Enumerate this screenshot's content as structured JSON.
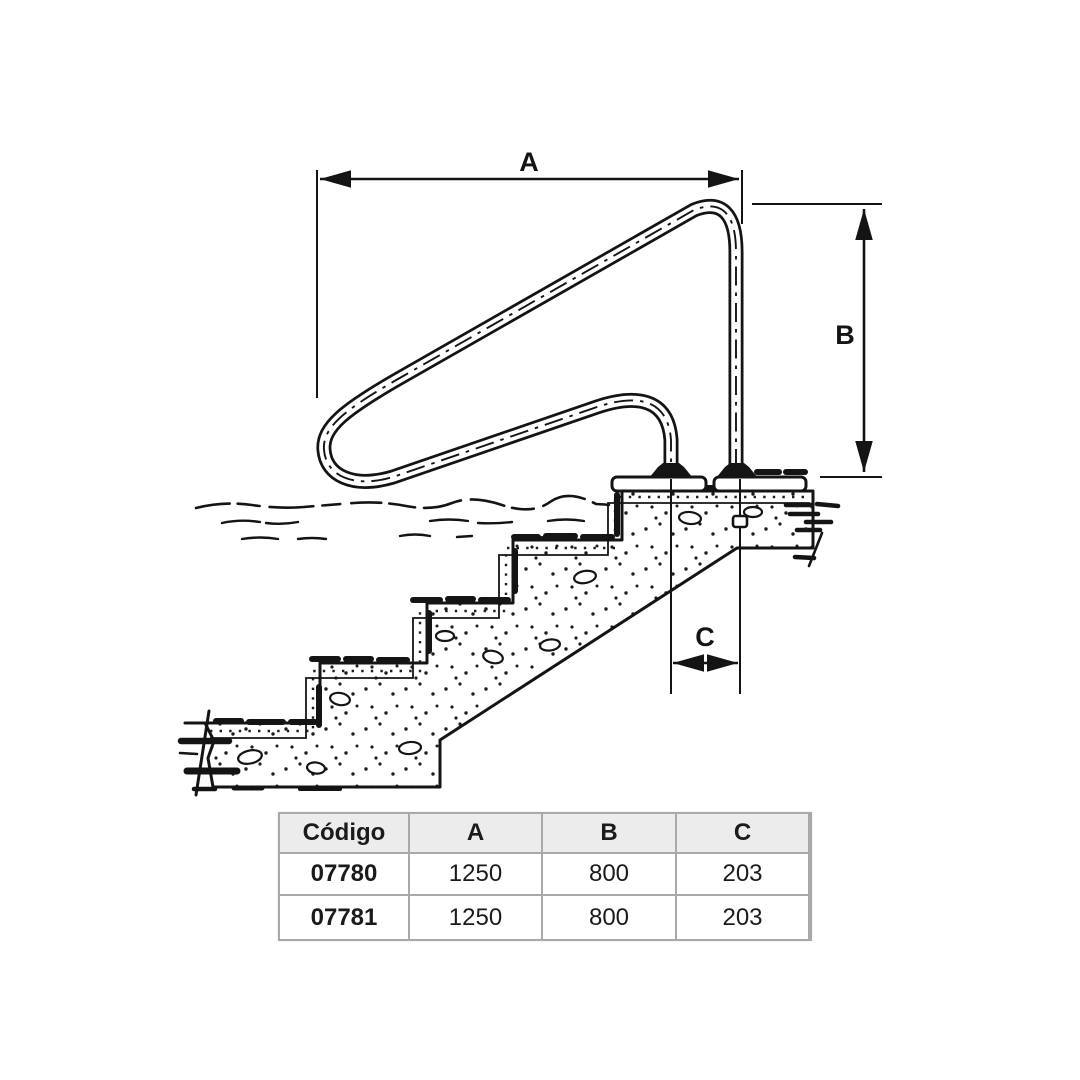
{
  "drawing": {
    "description": "Sectional technical drawing of a stainless pool stair handrail mounted on a deck above submerged concrete steps",
    "dim_a_label": "A",
    "dim_b_label": "B",
    "dim_c_label": "C"
  },
  "table": {
    "headers": [
      "Código",
      "A",
      "B",
      "C"
    ],
    "rows": [
      {
        "codigo": "07780",
        "a": "1250",
        "b": "800",
        "c": "203"
      },
      {
        "codigo": "07781",
        "a": "1250",
        "b": "800",
        "c": "203"
      }
    ]
  },
  "colors": {
    "ink": "#141414",
    "background": "#ffffff",
    "table_border": "#a9a9a9",
    "table_header_bg": "#ececec"
  }
}
